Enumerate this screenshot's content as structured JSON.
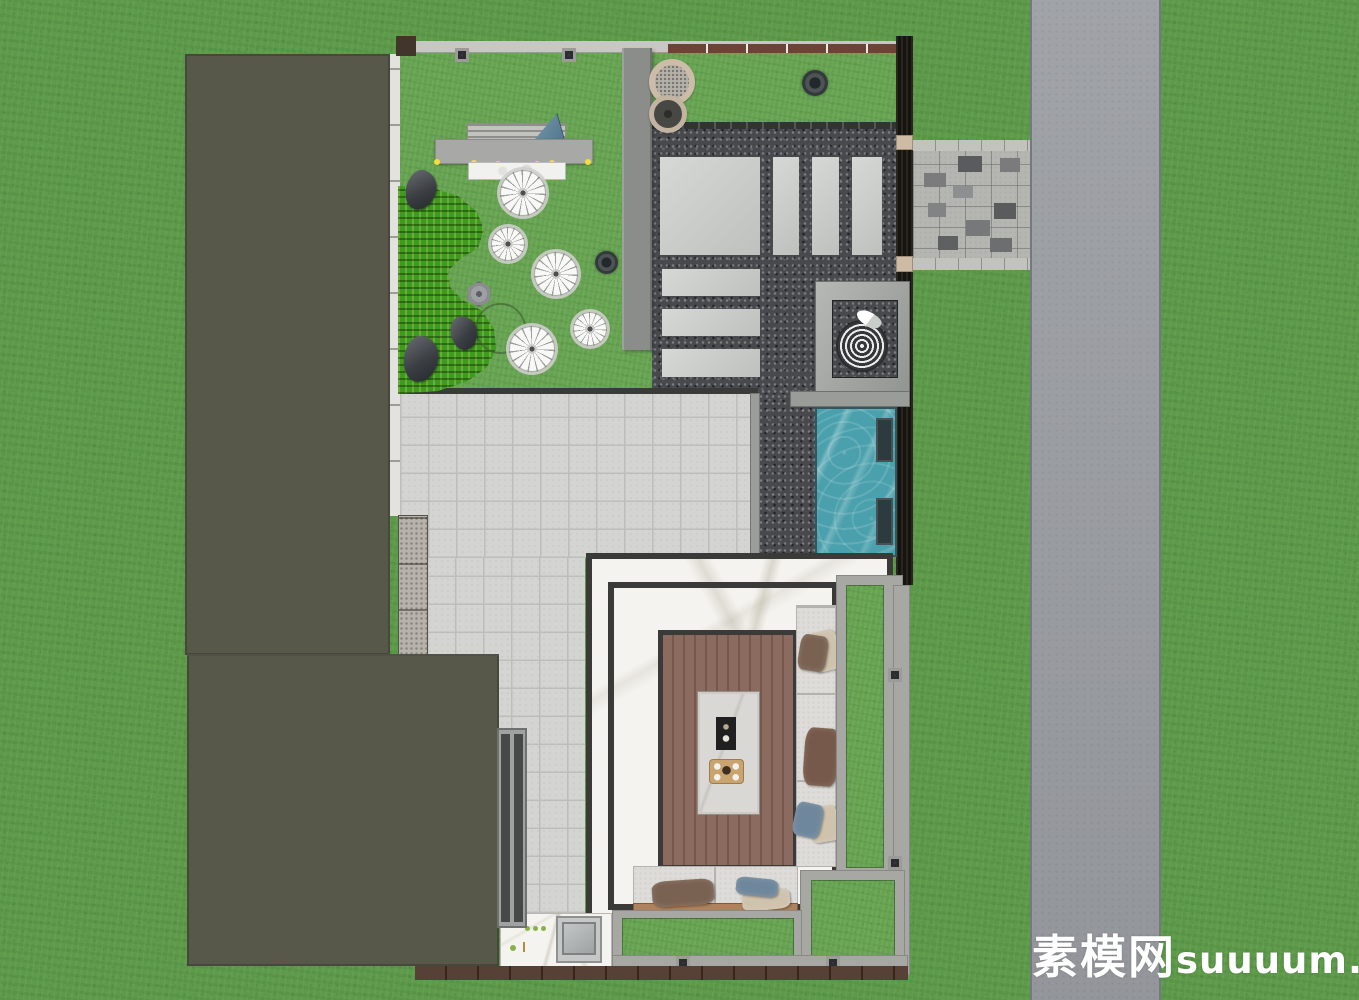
{
  "watermark": {
    "zh": "素模网",
    "latin": "suuuum.com",
    "color": "#ffffff"
  },
  "colors": {
    "grass_outer": "#5d9a49",
    "grass_lawn": "#67a452",
    "hedge_green": "#3f9a21",
    "road_gray": "#9b9ea3",
    "road_edge": "#75797d",
    "roof_olive": "#57574a",
    "stone_band": "#e2e2de",
    "wall_gray": "#8b8d8a",
    "wall_black": "#17130f",
    "beam_light": "#c7c7c3",
    "beam_concrete": "#a7a7a3",
    "gravel_dark": "#47494d",
    "paver_light": "#c9cbc8",
    "patio_tile": "#d4d5d3",
    "patio_line": "#bdbeba",
    "marble_white": "#f5f3ef",
    "wood_deck": "#8b6a5f",
    "wood_trim": "#ad825c",
    "wood_wall": "#4a3327",
    "pool_teal": "#4aa0ac",
    "pool_bench": "#2e3b3e",
    "sofa_fabric": "#dddcd8",
    "pillow_brown": "#7a6252",
    "pillow_blue": "#6f879c",
    "pillow_tan": "#cfc3ad",
    "island_marble": "#dad8d4",
    "fireplace_black": "#202020",
    "tray_tan": "#c9a46e",
    "gate_pillar": "#cdbba6",
    "path_tile": "#b5b6b1",
    "light_yellow": "#f2df3a",
    "watermark_white": "#ffffff"
  },
  "scene": {
    "type": "top-down courtyard landscape plan render",
    "zones": [
      "left-building-roof",
      "garden-lawn",
      "hedge",
      "pergola-bench",
      "zen-gravel-court",
      "stepping-pavers",
      "fire-pit-terrace",
      "entry-path",
      "road",
      "swimming-pool",
      "tile-patio",
      "living-pavilion",
      "wood-deck-lounge",
      "kitchen-counter",
      "planting-strips",
      "outer-lawn"
    ],
    "counts": {
      "flower_plants": 5,
      "planter_pots": 2,
      "shrub_pots": 2,
      "large_pavers": 7,
      "pergola_lights": 6,
      "pool_benches": 2,
      "sofa_pillows": 8
    }
  }
}
